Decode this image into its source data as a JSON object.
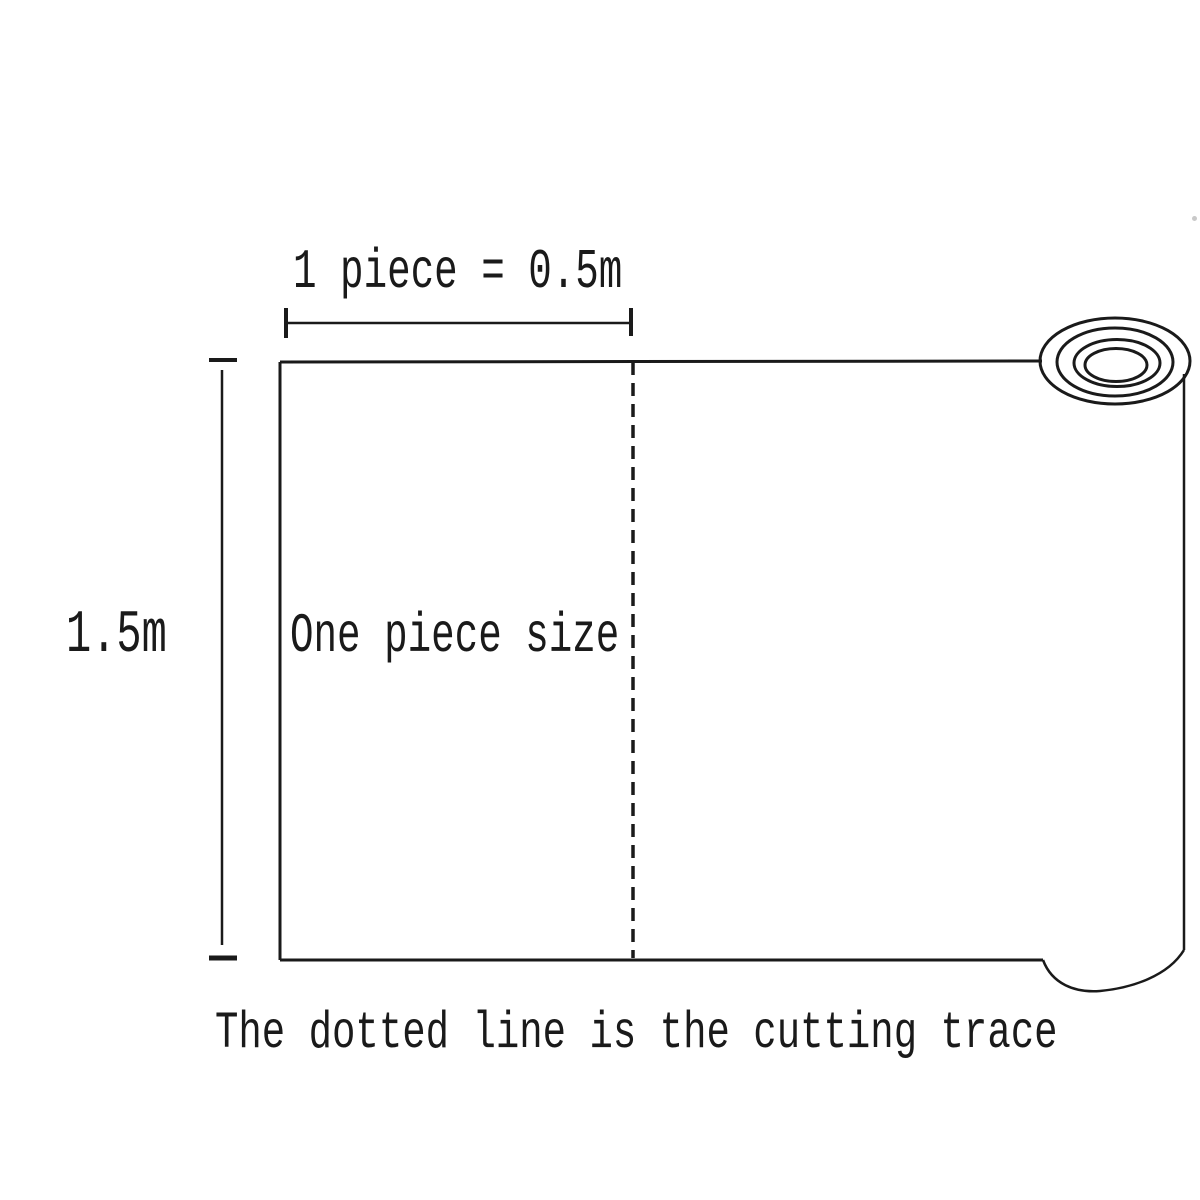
{
  "diagram": {
    "top_dimension_label": "1 piece = 0.5m",
    "left_dimension_label": "1.5m",
    "sheet_label": "One piece size",
    "caption": "The dotted line is the cutting trace",
    "dimensions": {
      "piece_width": "0.5m",
      "roll_height": "1.5m"
    },
    "colors": {
      "ink": "#1a1a1a",
      "background": "#ffffff"
    }
  }
}
